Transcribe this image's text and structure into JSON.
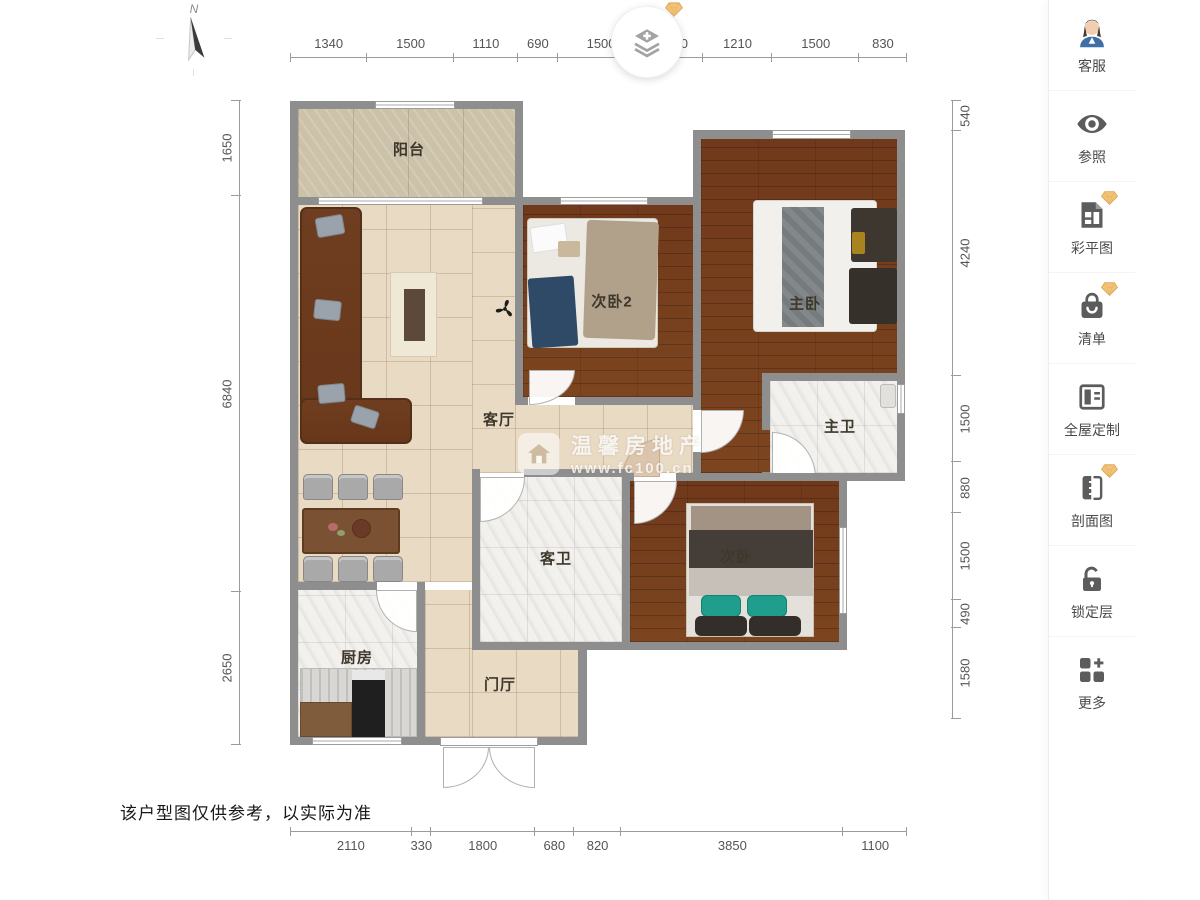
{
  "canvas": {
    "rooms": {
      "balcony": "阳台",
      "living": "客厅",
      "bedroom2": "次卧2",
      "master_bedroom": "主卧",
      "master_bath": "主卫",
      "guest_bath": "客卫",
      "bedroom": "次卧",
      "kitchen": "厨房",
      "foyer": "门厅"
    },
    "dims": {
      "top": [
        "1340",
        "1500",
        "1110",
        "690",
        "1500",
        "1010",
        "1210",
        "1500",
        "830"
      ],
      "bottom": [
        "2110",
        "330",
        "1800",
        "680",
        "820",
        "3850",
        "1100"
      ],
      "left": [
        "1650",
        "6840",
        "2650"
      ],
      "right": [
        "540",
        "4240",
        "1500",
        "880",
        "1500",
        "490",
        "1580"
      ]
    },
    "compass": {
      "north_label": "N"
    },
    "watermark": {
      "brand": "温馨房地产",
      "url": "www.fc100.cn"
    },
    "disclaimer": "该户型图仅供参考，以实际为准"
  },
  "sidebar": {
    "items": [
      {
        "label": "客服",
        "icon": "customer-service-avatar-icon",
        "premium": false
      },
      {
        "label": "参照",
        "icon": "eye-icon",
        "premium": false
      },
      {
        "label": "彩平图",
        "icon": "color-plan-document-icon",
        "premium": true
      },
      {
        "label": "清单",
        "icon": "shopping-bag-icon",
        "premium": true
      },
      {
        "label": "全屋定制",
        "icon": "wardrobe-icon",
        "premium": false
      },
      {
        "label": "剖面图",
        "icon": "section-view-icon",
        "premium": true
      },
      {
        "label": "锁定层",
        "icon": "unlocked-padlock-icon",
        "premium": false
      },
      {
        "label": "更多",
        "icon": "more-grid-plus-icon",
        "premium": false
      }
    ]
  },
  "colors": {
    "wall": "#8e8e8e",
    "tile_floor": "#e9dac4",
    "wood_floor": "#70391b",
    "marble_floor": "#f3f1ed",
    "balcony_floor": "#ccc2a9",
    "premium_gem": "#f2c377",
    "icon_gray": "#5c5c5c"
  }
}
